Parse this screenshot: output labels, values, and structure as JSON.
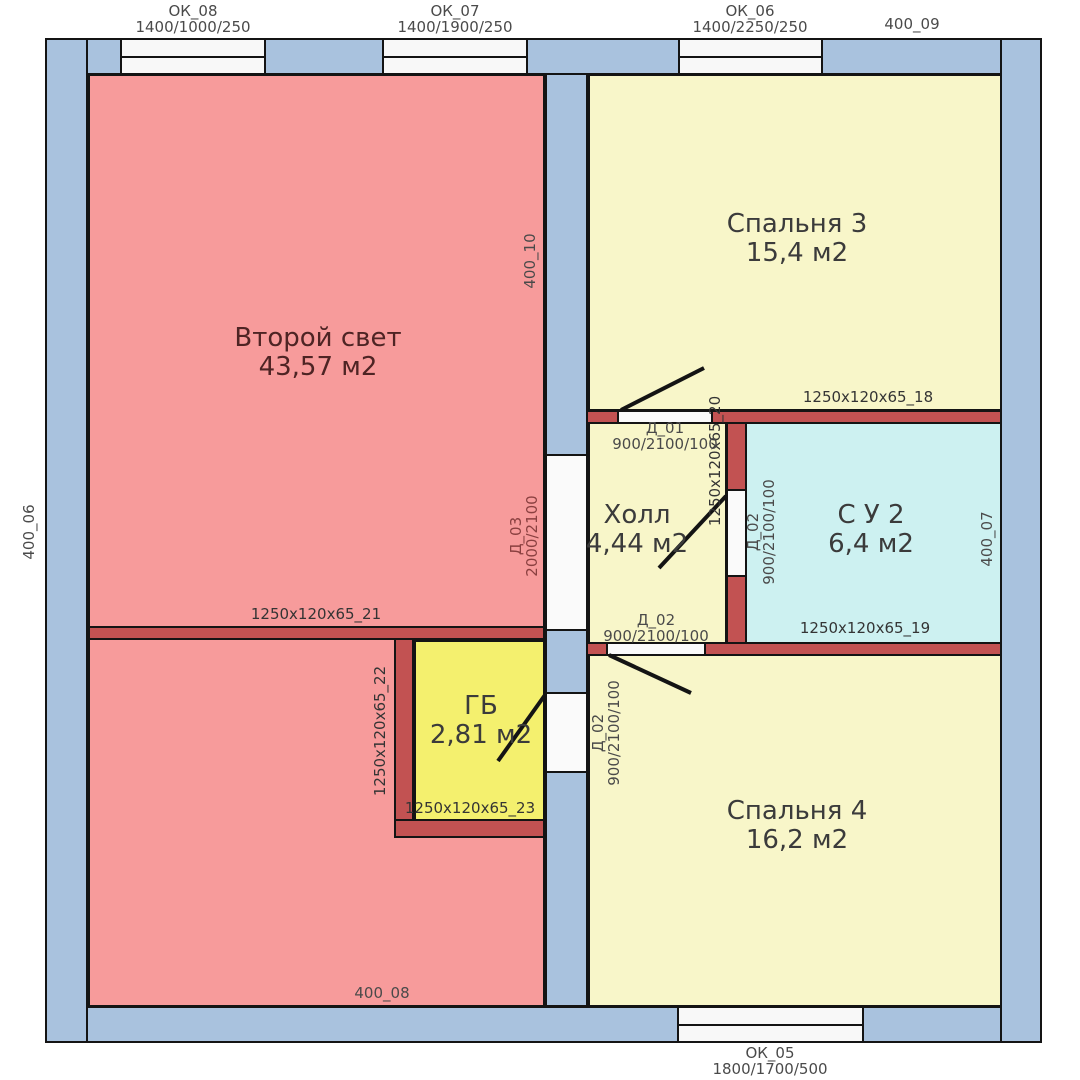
{
  "title": "floor-plan",
  "rooms": {
    "second_light": {
      "name": "Второй свет",
      "area": "43,57 м2"
    },
    "bedroom3": {
      "name": "Спальня 3",
      "area": "15,4 м2"
    },
    "hall": {
      "name": "Холл",
      "area": "4,44 м2"
    },
    "su2": {
      "name": "С У 2",
      "area": "6,4 м2"
    },
    "gb": {
      "name": "ГБ",
      "area": "2,81 м2"
    },
    "bedroom4": {
      "name": "Спальня 4",
      "area": "16,2 м2"
    }
  },
  "windows": {
    "ok08": {
      "name": "ОК_08",
      "size": "1400/1000/250"
    },
    "ok07": {
      "name": "ОК_07",
      "size": "1400/1900/250"
    },
    "ok06": {
      "name": "ОК_06",
      "size": "1400/2250/250"
    },
    "ok05": {
      "name": "ОК_05",
      "size": "1800/1700/500"
    }
  },
  "doors": {
    "d01": {
      "name": "Д_01",
      "size": "900/2100/100"
    },
    "d02_su2": {
      "name": "Д_02",
      "size": "900/2100/100"
    },
    "d02_bedroom4": {
      "name": "Д_02",
      "size": "900/2100/100"
    },
    "d02_gb": {
      "name": "Д_02",
      "size": "900/2100/100"
    },
    "d03": {
      "name": "Д_03",
      "size": "2000/2100"
    }
  },
  "wall_labels": {
    "l400_06": "400_06",
    "l400_07": "400_07",
    "l400_08": "400_08",
    "l400_09": "400_09",
    "l400_10": "400_10",
    "p18": "1250x120x65_18",
    "p19": "1250x120x65_19",
    "p20": "1250x120x65_20",
    "p21": "1250x120x65_21",
    "p22": "1250x120x65_22",
    "p23": "1250x120x65_23"
  },
  "colors": {
    "room_pink": "#f79b9b",
    "room_pale_yellow": "#f8f6c9",
    "room_bright_yellow": "#f4f06e",
    "room_cyan": "#cdf1f1",
    "wall_blue": "#a9c2de",
    "wall_red": "#c25252",
    "opening_white": "#fafafa",
    "outline_black": "#141414"
  }
}
